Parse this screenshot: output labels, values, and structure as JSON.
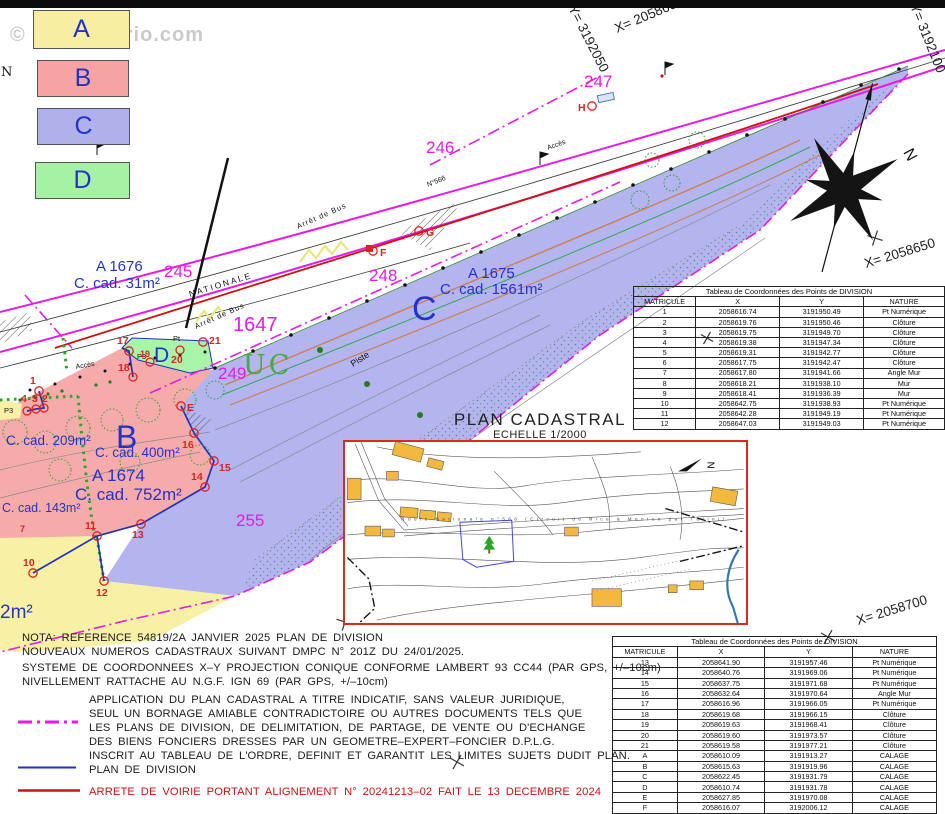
{
  "watermark": "© EtreProprio.com",
  "legend": {
    "items": [
      {
        "label": "A",
        "color": "#f7eea2"
      },
      {
        "label": "B",
        "color": "#f5a3a3"
      },
      {
        "label": "C",
        "color": "#b0b0ea"
      },
      {
        "label": "D",
        "color": "#a5f2a5"
      }
    ]
  },
  "map": {
    "north": "N",
    "zone": "UC",
    "lots": {
      "l245": "245",
      "l246": "246",
      "l247": "247",
      "l248": "248",
      "l249": "249",
      "l255": "255",
      "l1647": "1647"
    },
    "grid_labels": {
      "y1": "Y= 3192050",
      "x1": "X= 2058600",
      "y2": "Y= 3192100",
      "x2": "X= 2058650",
      "x3": "X= 2058700"
    },
    "parcels": {
      "a1676_name": "A 1676",
      "a1676_area": "C. cad. 31m²",
      "a1675_name": "A 1675",
      "a1675_area": "C. cad. 1561m²",
      "a1674_name": "A 1674",
      "a1674_area": "C. cad. 752m²",
      "area209": "C. cad. 209m²",
      "area400": "C. cad. 400m²",
      "area143": "C. cad. 143m²",
      "area2": "2m²"
    },
    "letters": {
      "b": "B",
      "c": "C",
      "d": "D"
    },
    "roads": {
      "nationale": "NATIONALE",
      "n566": "N°566",
      "arret1": "Arrêt de Bus",
      "arret2": "Arrêt de Bus",
      "acces1": "Accès",
      "acces2": "Accès",
      "piste": "Piste"
    },
    "points": [
      "1",
      "2",
      "3",
      "4",
      "7",
      "10",
      "11",
      "12",
      "13",
      "14",
      "15",
      "16",
      "17",
      "18",
      "19",
      "20",
      "21",
      "E",
      "F",
      "G",
      "H"
    ],
    "small_labels": {
      "p3a": "P3",
      "p3b": "P3",
      "pt": "Pt",
      "edge_n": "N"
    }
  },
  "tables": [
    {
      "title": "Tableau de Coordonnées des Points de DIVISION",
      "headers": [
        "MATRICULE",
        "X",
        "Y",
        "NATURE"
      ],
      "rows": [
        [
          "1",
          "2058616.74",
          "3191950.49",
          "Pt Numérique"
        ],
        [
          "2",
          "2058619.76",
          "3191950.46",
          "Clôture"
        ],
        [
          "3",
          "2058619.75",
          "3191949.70",
          "Clôture"
        ],
        [
          "4",
          "2058619.38",
          "3191947.34",
          "Clôture"
        ],
        [
          "5",
          "2058619.31",
          "3191942.77",
          "Clôture"
        ],
        [
          "6",
          "2058617.75",
          "3191942.47",
          "Clôture"
        ],
        [
          "7",
          "2058617.80",
          "3191941.66",
          "Angle Mur"
        ],
        [
          "8",
          "2058618.21",
          "3191938.10",
          "Mur"
        ],
        [
          "9",
          "2058618.41",
          "3191936.39",
          "Mur"
        ],
        [
          "10",
          "2058642.75",
          "3191938.93",
          "Pt Numérique"
        ],
        [
          "11",
          "2058642.28",
          "3191949.19",
          "Pt Numérique"
        ],
        [
          "12",
          "2058647.03",
          "3191949.03",
          "Pt Numérique"
        ]
      ]
    },
    {
      "title": "Tableau de Coordonnées des Points de DIVISION",
      "headers": [
        "MATRICULE",
        "X",
        "Y",
        "NATURE"
      ],
      "rows": [
        [
          "13",
          "2058641.90",
          "3191957.46",
          "Pt Numérique"
        ],
        [
          "14",
          "2058640.76",
          "3191969.06",
          "Pt Numérique"
        ],
        [
          "15",
          "2058637.75",
          "3191971.68",
          "Pt Numérique"
        ],
        [
          "16",
          "2058632.64",
          "3191970.64",
          "Angle Mur"
        ],
        [
          "17",
          "2058616.96",
          "3191966.05",
          "Pt Numérique"
        ],
        [
          "18",
          "2058619.68",
          "3191966.15",
          "Clôture"
        ],
        [
          "19",
          "2058619.63",
          "3191968.41",
          "Clôture"
        ],
        [
          "20",
          "2058619.60",
          "3191973.57",
          "Clôture"
        ],
        [
          "21",
          "2058619.58",
          "3191977.21",
          "Clôture"
        ],
        [
          "A",
          "2058610.09",
          "3191913.27",
          "CALAGE"
        ],
        [
          "B",
          "2058615.63",
          "3191919.96",
          "CALAGE"
        ],
        [
          "C",
          "2058622.45",
          "3191931.79",
          "CALAGE"
        ],
        [
          "D",
          "2058610.74",
          "3191931.78",
          "CALAGE"
        ],
        [
          "E",
          "2058627.85",
          "3191970.08",
          "CALAGE"
        ],
        [
          "F",
          "2058616.07",
          "3192006.12",
          "CALAGE"
        ]
      ]
    }
  ],
  "inset": {
    "title": "PLAN CADASTRAL",
    "scale": "ECHELLE 1/2000",
    "road_text": "Route  Nationale  n°566    (Circuit  de  Nice  à  Menton  par  Turini)",
    "north": "N"
  },
  "notes": {
    "nota1": "NOTA: REFERENCE 54819/2A JANVIER 2025 PLAN DE DIVISION",
    "nota2": "NOUVEAUX NUMEROS CADASTRAUX SUIVANT DMPC N° 201Z DU 24/01/2025.",
    "sys1": "SYSTEME DE COORDONNEES X–Y PROJECTION CONIQUE CONFORME LAMBERT 93 CC44 (PAR GPS, +/–10cm)",
    "sys2": "NIVELLEMENT RATTACHE AU N.G.F. IGN 69 (PAR GPS, +/–10cm)",
    "app1": "APPLICATION DU PLAN CADASTRAL A TITRE INDICATIF, SANS VALEUR JURIDIQUE,",
    "app2": "SEUL UN BORNAGE AMIABLE CONTRADICTOIRE OU AUTRES DOCUMENTS TELS QUE",
    "app3": "LES PLANS DE DIVISION, DE DELIMITATION, DE PARTAGE, DE VENTE OU D'ECHANGE",
    "app4": "DES BIENS FONCIERS DRESSES PAR UN GEOMETRE–EXPERT–FONCIER D.P.L.G.",
    "app5": "INSCRIT AU TABLEAU DE L'ORDRE, DEFINIT ET GARANTIT LES LIMITES SUJETS DUDIT PLAN.",
    "division": "PLAN DE DIVISION",
    "arrete": "ARRETE DE VOIRIE PORTANT ALIGNEMENT N° 20241213–02 FAIT LE 13 DECEMBRE 2024"
  }
}
